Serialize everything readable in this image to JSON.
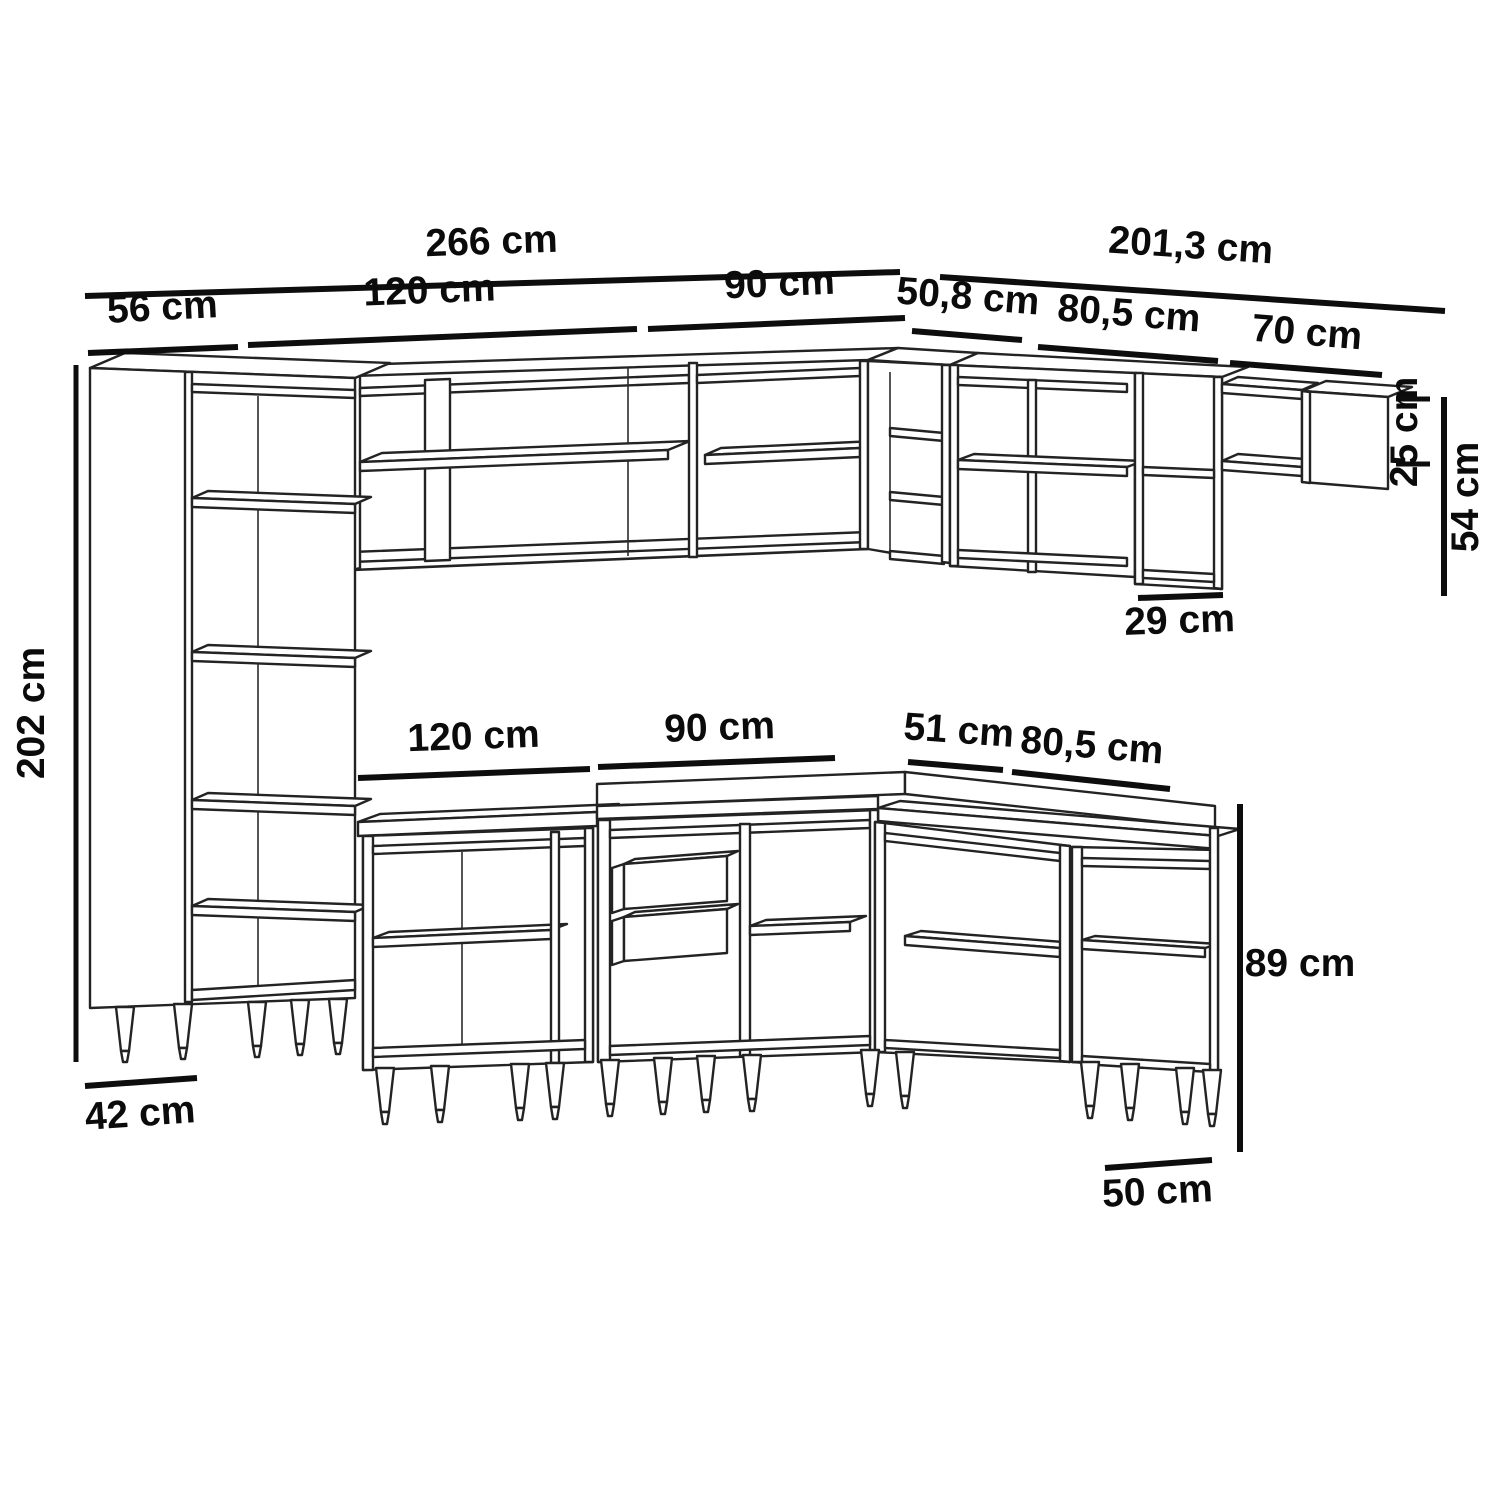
{
  "diagram": {
    "type": "furniture-dimension-line-drawing",
    "subject": "L-shaped modular kitchen cabinet set (tall pantry, wall cabinets, open shelf, base cabinets with drawers)",
    "units": "cm",
    "line_color": "#1f1f1f",
    "dimension_line_color": "#0d0d0d",
    "background_color": "#ffffff"
  },
  "runs": {
    "upper_left_run": {
      "total": "266 cm",
      "segments": [
        "56 cm",
        "120 cm",
        "90 cm"
      ]
    },
    "upper_right_run": {
      "total": "201,3 cm",
      "segments": [
        "50,8 cm",
        "80,5 cm",
        "70 cm"
      ]
    },
    "base_run_segments": [
      "120 cm",
      "90 cm",
      "51 cm",
      "80,5 cm"
    ],
    "heights": {
      "tall_cabinet": "202 cm",
      "wall_cabinet": "54 cm",
      "open_shelf": "25 cm",
      "base_cabinet": "89 cm"
    },
    "depths": {
      "tall_cabinet": "42 cm",
      "wall_cabinet": "29 cm",
      "base_cabinet": "50 cm"
    }
  },
  "labels": {
    "d266": "266 cm",
    "d56": "56 cm",
    "d120top": "120 cm",
    "d90top": "90 cm",
    "d2013": "201,3 cm",
    "d508": "50,8 cm",
    "d805top": "80,5 cm",
    "d70": "70 cm",
    "d202": "202 cm",
    "d42": "42 cm",
    "d25": "25 cm",
    "d54": "54 cm",
    "d29": "29 cm",
    "d120mid": "120 cm",
    "d90mid": "90 cm",
    "d51": "51 cm",
    "d805mid": "80,5 cm",
    "d89": "89 cm",
    "d50": "50 cm"
  }
}
